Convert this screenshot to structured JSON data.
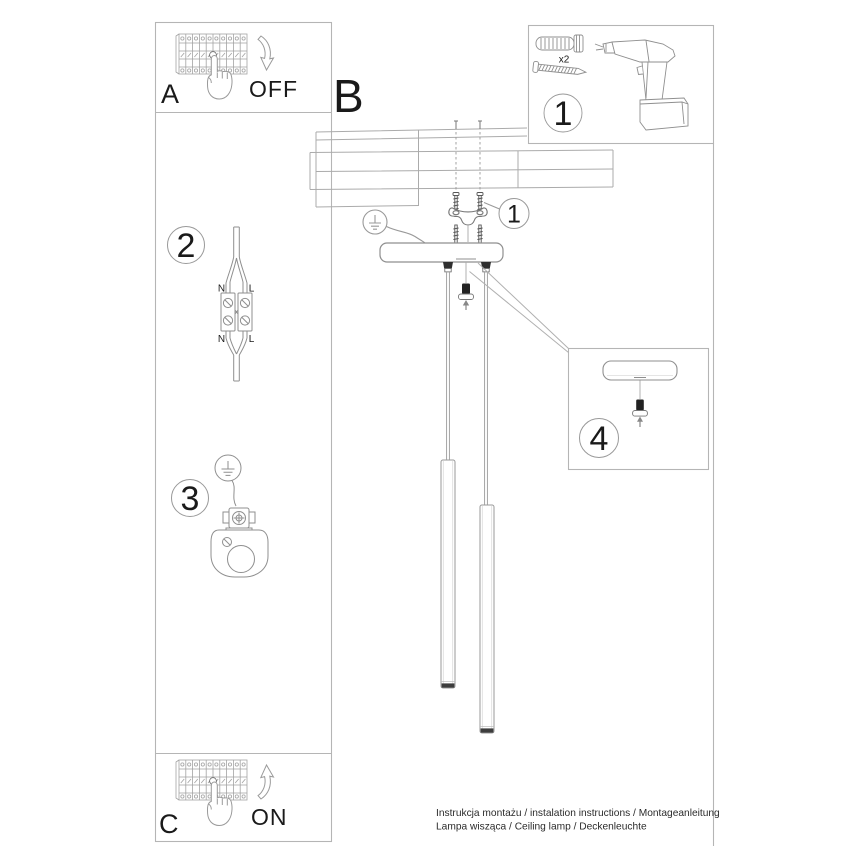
{
  "page": {
    "background": "#ffffff",
    "type": "assembly-instruction-sheet"
  },
  "colors": {
    "line_art": "#9b9b9b",
    "panel_border": "#b5b5b5",
    "dark_parts": "#2e2e2e",
    "text": "#1a1a1a"
  },
  "panels": {
    "a": {
      "label": "A",
      "switch_state": "OFF"
    },
    "b": {
      "label": "B"
    },
    "c": {
      "label": "C",
      "switch_state": "ON"
    },
    "kit": {
      "step_number": "1",
      "dowel_quantity": "x2"
    },
    "wiring": {
      "step_number": "2",
      "terminal_labels": {
        "top_left": "N",
        "top_right": "L",
        "bottom_left": "N",
        "bottom_right": "L"
      }
    },
    "ground": {
      "step_number": "3"
    },
    "canopy_detail": {
      "step_number": "4"
    },
    "bracket_callout": {
      "step_number": "1"
    }
  },
  "footer": {
    "line1": "Instrukcja montażu / instalation instructions / Montageanleitung",
    "line2": "Lampa wisząca / Ceiling lamp / Deckenleuchte"
  },
  "illustrations": [
    "circuit-breaker-row",
    "pointing-hand",
    "curved-arrow",
    "wall-plug",
    "screw",
    "cordless-drill",
    "suspended-ceiling",
    "mounting-bracket",
    "ceiling-canopy",
    "cord-grip",
    "pendant-cable",
    "pendant-tube-lamp",
    "terminal-block-wiring",
    "earth-ground-symbol",
    "ground-clamp",
    "lamp-socket",
    "strain-relief-plug"
  ]
}
